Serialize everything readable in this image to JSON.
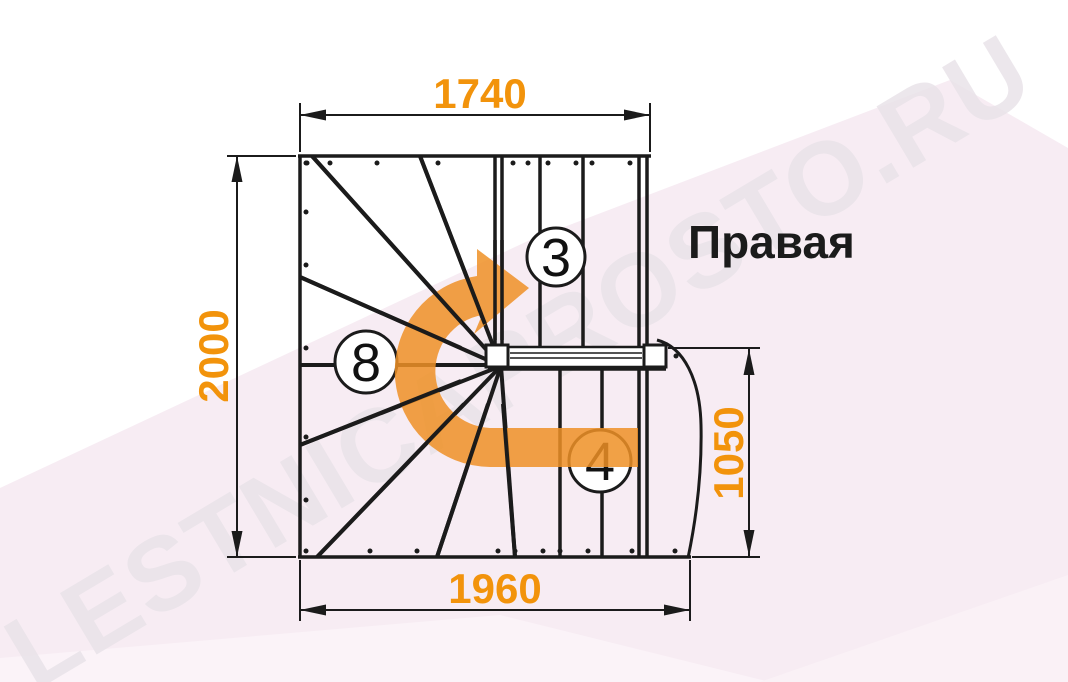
{
  "title": "Правая",
  "watermark": "LESTNICAPROSTO.RU",
  "dimensions": {
    "top": "1740",
    "left": "2000",
    "bottom": "1960",
    "right": "1050"
  },
  "step_counts": {
    "top_flight": "3",
    "winder": "8",
    "bottom_flight": "4"
  },
  "colors": {
    "accent": "#F2930B",
    "arrow": "#EE9126",
    "line": "#1B1B1B",
    "pink_band": "#F7ECF3",
    "watermark": "#E9E3E9"
  }
}
